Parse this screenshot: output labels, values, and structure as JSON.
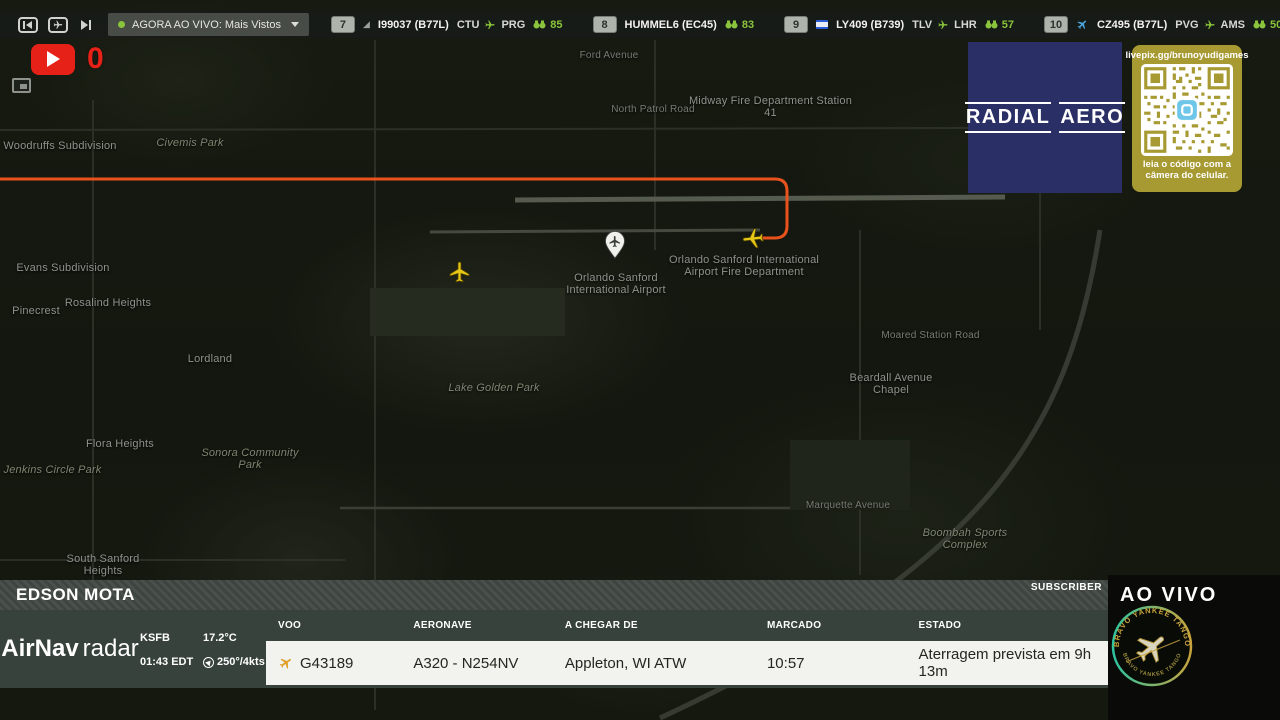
{
  "topbar": {
    "live_dropdown": {
      "label": "AGORA AO VIVO: Mais Vistos"
    },
    "flights": [
      {
        "rank": "7",
        "callsign": "I99037 (B77L)",
        "origin": "CTU",
        "destination": "PRG",
        "viewers": "85"
      },
      {
        "rank": "8",
        "callsign": "HUMMEL6 (EC45)",
        "viewers": "83"
      },
      {
        "rank": "9",
        "callsign": "LY409 (B739)",
        "origin": "TLV",
        "destination": "LHR",
        "viewers": "57"
      },
      {
        "rank": "10",
        "callsign": "CZ495 (B77L)",
        "origin": "PVG",
        "destination": "AMS",
        "viewers": "50"
      }
    ]
  },
  "overlay": {
    "youtube_count": "0"
  },
  "sponsor": {
    "word1": "RADIAL",
    "word2": "AERO"
  },
  "qr": {
    "url": "livepix.gg/brunoyudigames",
    "caption_line1": "leia o código com a",
    "caption_line2": "câmera do celular."
  },
  "map": {
    "labels": [
      {
        "text": "Woodruffs Subdivision"
      },
      {
        "text": "Civemis Park"
      },
      {
        "text": "Evans Subdivision"
      },
      {
        "text": "Pinecrest"
      },
      {
        "text": "Rosalind Heights"
      },
      {
        "text": "Lordland"
      },
      {
        "text": "Flora Heights"
      },
      {
        "text": "Jenkins Circle Park"
      },
      {
        "text": "Sonora Community Park"
      },
      {
        "text": "South Sanford Heights"
      },
      {
        "text": "Lake Golden Park"
      },
      {
        "text": "Orlando Sanford International Airport"
      },
      {
        "text": "Orlando Sanford International Airport Fire Department"
      },
      {
        "text": "Midway Fire Department Station 41"
      },
      {
        "text": "North Patrol Road"
      },
      {
        "text": "Ford Avenue"
      },
      {
        "text": "Beardall Avenue Chapel"
      },
      {
        "text": "Moared Station Road"
      },
      {
        "text": "Boombah Sports Complex"
      },
      {
        "text": "Marquette Avenue"
      }
    ]
  },
  "bottom": {
    "streamer": "EDSON MOTA",
    "subscriber": "SUBSCRIBER",
    "live": "AO VIVO",
    "brand": {
      "name": "AirNav",
      "suffix": "radar"
    },
    "station": {
      "code": "KSFB",
      "time": "01:43 EDT",
      "temp": "17.2°C",
      "wind": "250°/4kts"
    },
    "table": {
      "headers": [
        "VOO",
        "AERONAVE",
        "A CHEGAR DE",
        "MARCADO",
        "ESTADO"
      ],
      "row": {
        "voo": "G43189",
        "aeronave": "A320 - N254NV",
        "a_chegar_de": "Appleton, WI ATW",
        "marcado": "10:57",
        "estado": "Aterragem prevista em 9h 13m"
      }
    },
    "badge_text_top": "BRAVO YANKEE TANGO",
    "badge_text_bottom": "BRAVO YANKEE TANGO"
  },
  "colors": {
    "accent_green": "#8ac43c",
    "path_orange": "#f2551f",
    "sponsor_navy": "#2a3066",
    "qr_olive": "#a89a33",
    "live_red": "#e62117"
  }
}
